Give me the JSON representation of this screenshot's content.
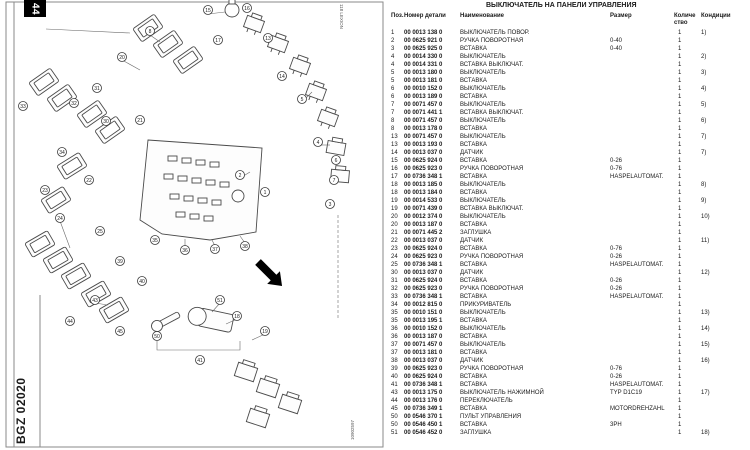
{
  "page": {
    "tab_number": "44",
    "brand_logo": "CLAAS",
    "catalog_code": "BGZ 02020",
    "edge_code_top": "118 LEXION",
    "edge_code_bottom": "10902597"
  },
  "parts_table": {
    "title": "ВЫКЛЮЧАТЕЛЬ НА ПАНЕЛИ УПРАВЛЕНИЯ",
    "columns": {
      "pos": "Поз.",
      "part_number": "Номер детали",
      "name": "Наименование",
      "size": "Размер",
      "qty_line1": "Количе",
      "qty_line2": "ство",
      "note": "Кондиции"
    },
    "rows": [
      {
        "pos": "1",
        "part": "00 0013 138 0",
        "name": "ВЫКЛЮЧАТЕЛЬ ПОВОР.",
        "size": "",
        "qty": "1",
        "note": "1)"
      },
      {
        "pos": "2",
        "part": "00 0625 921 0",
        "name": "РУЧКА ПОВОРОТНАЯ",
        "size": "0-40",
        "qty": "1",
        "note": ""
      },
      {
        "pos": "3",
        "part": "00 0625 925 0",
        "name": "ВСТАВКА",
        "size": "0-40",
        "qty": "1",
        "note": ""
      },
      {
        "pos": "4",
        "part": "00 0014 330 0",
        "name": "ВЫКЛЮЧАТЕЛЬ",
        "size": "",
        "qty": "1",
        "note": "2)"
      },
      {
        "pos": "4",
        "part": "00 0014 331 0",
        "name": "ВСТАВКА ВЫКЛЮЧАТ.",
        "size": "",
        "qty": "1",
        "note": ""
      },
      {
        "pos": "5",
        "part": "00 0013 180 0",
        "name": "ВЫКЛЮЧАТЕЛЬ",
        "size": "",
        "qty": "1",
        "note": "3)"
      },
      {
        "pos": "5",
        "part": "00 0013 181 0",
        "name": "ВСТАВКА",
        "size": "",
        "qty": "1",
        "note": ""
      },
      {
        "pos": "6",
        "part": "00 0010 152 0",
        "name": "ВЫКЛЮЧАТЕЛЬ",
        "size": "",
        "qty": "1",
        "note": "4)"
      },
      {
        "pos": "6",
        "part": "00 0013 189 0",
        "name": "ВСТАВКА",
        "size": "",
        "qty": "1",
        "note": ""
      },
      {
        "pos": "7",
        "part": "00 0071 457 0",
        "name": "ВЫКЛЮЧАТЕЛЬ",
        "size": "",
        "qty": "1",
        "note": "5)"
      },
      {
        "pos": "7",
        "part": "00 0071 441 1",
        "name": "ВСТАВКА ВЫКЛЮЧАТ.",
        "size": "",
        "qty": "1",
        "note": ""
      },
      {
        "pos": "8",
        "part": "00 0071 457 0",
        "name": "ВЫКЛЮЧАТЕЛЬ",
        "size": "",
        "qty": "1",
        "note": "6)"
      },
      {
        "pos": "8",
        "part": "00 0013 178 0",
        "name": "ВСТАВКА",
        "size": "",
        "qty": "1",
        "note": ""
      },
      {
        "pos": "13",
        "part": "00 0071 457 0",
        "name": "ВЫКЛЮЧАТЕЛЬ",
        "size": "",
        "qty": "1",
        "note": "7)"
      },
      {
        "pos": "13",
        "part": "00 0013 193 0",
        "name": "ВСТАВКА",
        "size": "",
        "qty": "1",
        "note": ""
      },
      {
        "pos": "14",
        "part": "00 0013 037 0",
        "name": "ДАТЧИК",
        "size": "",
        "qty": "1",
        "note": "7)"
      },
      {
        "pos": "15",
        "part": "00 0625 924 0",
        "name": "ВСТАВКА",
        "size": "0-26",
        "qty": "1",
        "note": ""
      },
      {
        "pos": "16",
        "part": "00 0625 923 0",
        "name": "РУЧКА ПОВОРОТНАЯ",
        "size": "0-76",
        "qty": "1",
        "note": ""
      },
      {
        "pos": "17",
        "part": "00 0736 348 1",
        "name": "ВСТАВКА",
        "size": "HASPELAUTOMAT.",
        "qty": "1",
        "note": ""
      },
      {
        "pos": "18",
        "part": "00 0013 185 0",
        "name": "ВЫКЛЮЧАТЕЛЬ",
        "size": "",
        "qty": "1",
        "note": "8)"
      },
      {
        "pos": "18",
        "part": "00 0013 184 0",
        "name": "ВСТАВКА",
        "size": "",
        "qty": "1",
        "note": ""
      },
      {
        "pos": "19",
        "part": "00 0014 533 0",
        "name": "ВЫКЛЮЧАТЕЛЬ",
        "size": "",
        "qty": "1",
        "note": "9)"
      },
      {
        "pos": "19",
        "part": "00 0071 439 0",
        "name": "ВСТАВКА ВЫКЛЮЧАТ.",
        "size": "",
        "qty": "1",
        "note": ""
      },
      {
        "pos": "20",
        "part": "00 0012 374 0",
        "name": "ВЫКЛЮЧАТЕЛЬ",
        "size": "",
        "qty": "1",
        "note": "10)"
      },
      {
        "pos": "20",
        "part": "00 0013 187 0",
        "name": "ВСТАВКА",
        "size": "",
        "qty": "1",
        "note": ""
      },
      {
        "pos": "21",
        "part": "00 0071 445 2",
        "name": "ЗАГЛУШКА",
        "size": "",
        "qty": "1",
        "note": ""
      },
      {
        "pos": "22",
        "part": "00 0013 037 0",
        "name": "ДАТЧИК",
        "size": "",
        "qty": "1",
        "note": "11)"
      },
      {
        "pos": "23",
        "part": "00 0625 924 0",
        "name": "ВСТАВКА",
        "size": "0-76",
        "qty": "1",
        "note": ""
      },
      {
        "pos": "24",
        "part": "00 0625 923 0",
        "name": "РУЧКА ПОВОРОТНАЯ",
        "size": "0-26",
        "qty": "1",
        "note": ""
      },
      {
        "pos": "25",
        "part": "00 0736 348 1",
        "name": "ВСТАВКА",
        "size": "HASPELAUTOMAT.",
        "qty": "1",
        "note": ""
      },
      {
        "pos": "30",
        "part": "00 0013 037 0",
        "name": "ДАТЧИК",
        "size": "",
        "qty": "1",
        "note": "12)"
      },
      {
        "pos": "31",
        "part": "00 0625 924 0",
        "name": "ВСТАВКА",
        "size": "0-26",
        "qty": "1",
        "note": ""
      },
      {
        "pos": "32",
        "part": "00 0625 923 0",
        "name": "РУЧКА ПОВОРОТНАЯ",
        "size": "0-26",
        "qty": "1",
        "note": ""
      },
      {
        "pos": "33",
        "part": "00 0736 348 1",
        "name": "ВСТАВКА",
        "size": "HASPELAUTOMAT.",
        "qty": "1",
        "note": ""
      },
      {
        "pos": "34",
        "part": "00 0012 815 0",
        "name": "ПРИКУРИВАТЕЛЬ",
        "size": "",
        "qty": "1",
        "note": ""
      },
      {
        "pos": "35",
        "part": "00 0010 151 0",
        "name": "ВЫКЛЮЧАТЕЛЬ",
        "size": "",
        "qty": "1",
        "note": "13)"
      },
      {
        "pos": "35",
        "part": "00 0013 195 1",
        "name": "ВСТАВКА",
        "size": "",
        "qty": "1",
        "note": ""
      },
      {
        "pos": "36",
        "part": "00 0010 152 0",
        "name": "ВЫКЛЮЧАТЕЛЬ",
        "size": "",
        "qty": "1",
        "note": "14)"
      },
      {
        "pos": "36",
        "part": "00 0013 187 0",
        "name": "ВСТАВКА",
        "size": "",
        "qty": "1",
        "note": ""
      },
      {
        "pos": "37",
        "part": "00 0071 457 0",
        "name": "ВЫКЛЮЧАТЕЛЬ",
        "size": "",
        "qty": "1",
        "note": "15)"
      },
      {
        "pos": "37",
        "part": "00 0013 181 0",
        "name": "ВСТАВКА",
        "size": "",
        "qty": "1",
        "note": ""
      },
      {
        "pos": "38",
        "part": "00 0013 037 0",
        "name": "ДАТЧИК",
        "size": "",
        "qty": "1",
        "note": "16)"
      },
      {
        "pos": "39",
        "part": "00 0625 923 0",
        "name": "РУЧКА ПОВОРОТНАЯ",
        "size": "0-76",
        "qty": "1",
        "note": ""
      },
      {
        "pos": "40",
        "part": "00 0625 924 0",
        "name": "ВСТАВКА",
        "size": "0-26",
        "qty": "1",
        "note": ""
      },
      {
        "pos": "41",
        "part": "00 0736 348 1",
        "name": "ВСТАВКА",
        "size": "HASPELAUTOMAT.",
        "qty": "1",
        "note": ""
      },
      {
        "pos": "43",
        "part": "00 0013 175 0",
        "name": "ВЫКЛЮЧАТЕЛЬ НАЖИМНОЙ",
        "size": "TYP D1C19",
        "qty": "1",
        "note": "17)"
      },
      {
        "pos": "44",
        "part": "00 0013 176 0",
        "name": "ПЕРЕКЛЮЧАТЕЛЬ",
        "size": "",
        "qty": "1",
        "note": ""
      },
      {
        "pos": "45",
        "part": "00 0736 349 1",
        "name": "ВСТАВКА",
        "size": "MOTORDREHZAHL",
        "qty": "1",
        "note": ""
      },
      {
        "pos": "50",
        "part": "00 0546 370 1",
        "name": "ПУЛЬТ УПРАВЛЕНИЯ",
        "size": "",
        "qty": "1",
        "note": ""
      },
      {
        "pos": "50",
        "part": "00 0546 450 1",
        "name": "ВСТАВКА",
        "size": "3PH",
        "qty": "1",
        "note": ""
      },
      {
        "pos": "51",
        "part": "00 0546 452 0",
        "name": "ЗАГЛУШКА",
        "size": "",
        "qty": "1",
        "note": "18)"
      }
    ]
  },
  "diagram": {
    "callouts": [
      {
        "x": 208,
        "y": 10,
        "label": "15"
      },
      {
        "x": 247,
        "y": 8,
        "label": "16"
      },
      {
        "x": 150,
        "y": 31,
        "label": "8"
      },
      {
        "x": 218,
        "y": 40,
        "label": "17"
      },
      {
        "x": 268,
        "y": 38,
        "label": "13"
      },
      {
        "x": 122,
        "y": 57,
        "label": "20"
      },
      {
        "x": 282,
        "y": 76,
        "label": "14"
      },
      {
        "x": 97,
        "y": 88,
        "label": "31"
      },
      {
        "x": 74,
        "y": 103,
        "label": "32"
      },
      {
        "x": 23,
        "y": 106,
        "label": "33"
      },
      {
        "x": 302,
        "y": 99,
        "label": "5"
      },
      {
        "x": 106,
        "y": 121,
        "label": "30"
      },
      {
        "x": 140,
        "y": 120,
        "label": "21"
      },
      {
        "x": 62,
        "y": 152,
        "label": "34"
      },
      {
        "x": 318,
        "y": 142,
        "label": "4"
      },
      {
        "x": 89,
        "y": 180,
        "label": "22"
      },
      {
        "x": 336,
        "y": 160,
        "label": "6"
      },
      {
        "x": 45,
        "y": 190,
        "label": "23"
      },
      {
        "x": 334,
        "y": 180,
        "label": "7"
      },
      {
        "x": 60,
        "y": 218,
        "label": "24"
      },
      {
        "x": 100,
        "y": 231,
        "label": "25"
      },
      {
        "x": 330,
        "y": 204,
        "label": "3"
      },
      {
        "x": 240,
        "y": 175,
        "label": "2"
      },
      {
        "x": 265,
        "y": 192,
        "label": "1"
      },
      {
        "x": 155,
        "y": 240,
        "label": "35"
      },
      {
        "x": 185,
        "y": 250,
        "label": "36"
      },
      {
        "x": 215,
        "y": 249,
        "label": "37"
      },
      {
        "x": 245,
        "y": 246,
        "label": "38"
      },
      {
        "x": 120,
        "y": 261,
        "label": "39"
      },
      {
        "x": 142,
        "y": 281,
        "label": "40"
      },
      {
        "x": 95,
        "y": 300,
        "label": "43"
      },
      {
        "x": 70,
        "y": 321,
        "label": "44"
      },
      {
        "x": 120,
        "y": 331,
        "label": "45"
      },
      {
        "x": 157,
        "y": 336,
        "label": "50"
      },
      {
        "x": 220,
        "y": 300,
        "label": "51"
      },
      {
        "x": 237,
        "y": 316,
        "label": "18"
      },
      {
        "x": 265,
        "y": 331,
        "label": "19"
      },
      {
        "x": 200,
        "y": 360,
        "label": "41"
      }
    ]
  }
}
